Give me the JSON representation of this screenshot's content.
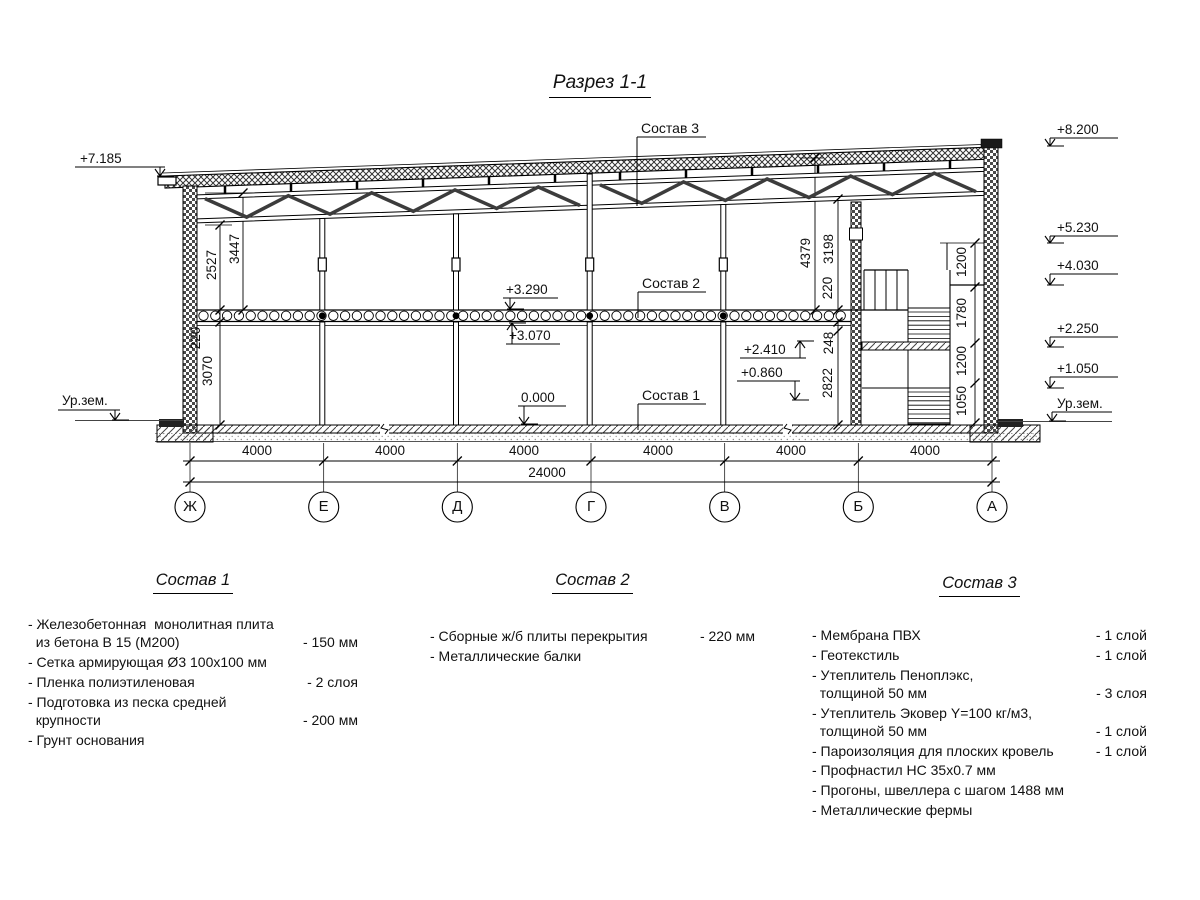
{
  "title": "Разрез 1-1",
  "drawing": {
    "axes": [
      "Ж",
      "Е",
      "Д",
      "Г",
      "В",
      "Б",
      "А"
    ],
    "span_dims": [
      "4000",
      "4000",
      "4000",
      "4000",
      "4000",
      "4000"
    ],
    "total_dim": "24000",
    "elevations_left": {
      "roof": "+7.185",
      "ground": "Ур.зем."
    },
    "elevations_right": {
      "parapet": "+8.200",
      "truss": "+5.230",
      "landing2": "+4.030",
      "landing1": "+2.250",
      "half": "+1.050",
      "ground": "Ур.зем."
    },
    "elevations_inline": {
      "slab_top": "+3.290",
      "slab_bottom": "+3.070",
      "floor": "0.000",
      "opening_top": "+2.410",
      "opening_bottom": "+0.860"
    },
    "dims_left": [
      "2527",
      "3447",
      "220",
      "3070"
    ],
    "dims_right": [
      "4379",
      "3198",
      "220",
      "248",
      "2822"
    ],
    "dims_stair": [
      "1200",
      "1780",
      "1200",
      "1050"
    ],
    "callouts": {
      "roof": "Состав 3",
      "slab": "Состав 2",
      "floor": "Состав 1"
    }
  },
  "legend1": {
    "title": "Состав 1",
    "items": [
      {
        "text": "- Железобетонная  монолитная плита\n  из бетона В 15 (М200)",
        "value": "- 150 мм"
      },
      {
        "text": "- Сетка армирующая Ø3 100х100 мм",
        "value": ""
      },
      {
        "text": "- Пленка полиэтиленовая",
        "value": "- 2 слоя"
      },
      {
        "text": "- Подготовка из песка средней\n  крупности",
        "value": "- 200 мм"
      },
      {
        "text": "- Грунт основания",
        "value": ""
      }
    ]
  },
  "legend2": {
    "title": "Состав 2",
    "items": [
      {
        "text": "- Сборные ж/б плиты перекрытия",
        "value": "- 220 мм"
      },
      {
        "text": "- Металлические балки",
        "value": ""
      }
    ]
  },
  "legend3": {
    "title": "Состав 3",
    "items": [
      {
        "text": "- Мембрана ПВХ",
        "value": "- 1 слой"
      },
      {
        "text": "- Геотекстиль",
        "value": "- 1 слой"
      },
      {
        "text": "- Утеплитель Пеноплэкс,\n  толщиной 50 мм",
        "value": "- 3 слоя"
      },
      {
        "text": "- Утеплитель Эковер Y=100 кг/м3,\n  толщиной 50 мм",
        "value": "- 1 слой"
      },
      {
        "text": "- Пароизоляция для плоских кровель",
        "value": "- 1 слой"
      },
      {
        "text": "- Профнастил НС 35х0.7 мм",
        "value": ""
      },
      {
        "text": "- Прогоны, швеллера с шагом 1488 мм",
        "value": ""
      },
      {
        "text": "- Металлические фермы",
        "value": ""
      }
    ]
  }
}
